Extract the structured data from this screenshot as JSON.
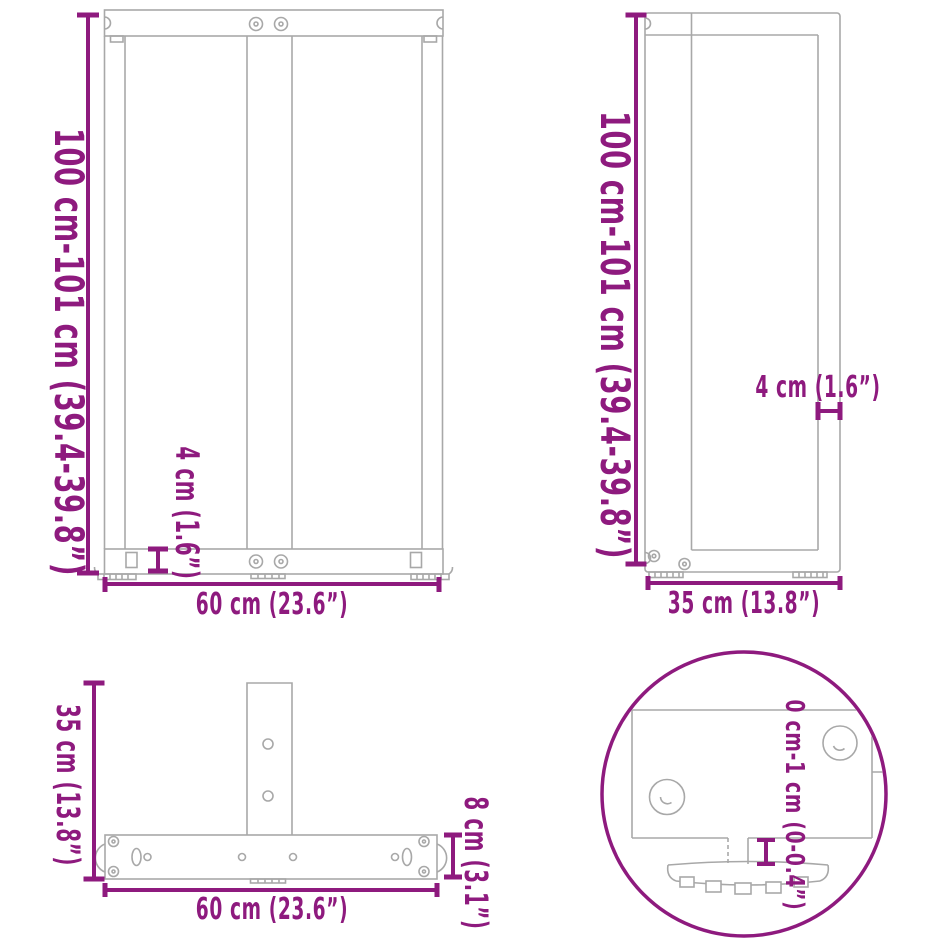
{
  "colors": {
    "dimension": "#8E1A7E",
    "outline": "#A8A8A8",
    "background": "#FFFFFF"
  },
  "views": {
    "front": {
      "height_label": "100 cm-101 cm (39.4-39.8”)",
      "foot_height_label": "4 cm (1.6”)",
      "width_label": "60 cm (23.6”)"
    },
    "side": {
      "height_label": "100 cm-101 cm (39.4-39.8”)",
      "profile_label": "4 cm (1.6”)",
      "depth_label": "35 cm (13.8”)"
    },
    "top": {
      "depth_label": "35 cm (13.8”)",
      "bar_height_label": "8 cm (3.1”)",
      "width_label": "60 cm (23.6”)"
    },
    "detail": {
      "adjustable_range_label": "0 cm-1 cm (0-0.4”)"
    }
  }
}
